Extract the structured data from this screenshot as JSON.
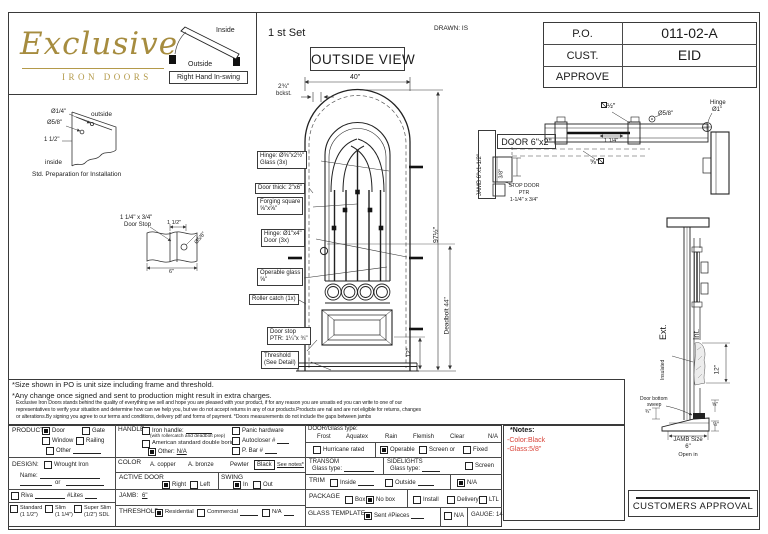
{
  "colors": {
    "brand_gold": "#a68c3f",
    "note_red": "#d9453a",
    "line": "#3a3a3a"
  },
  "header": {
    "logo_title": "Exclusive",
    "logo_subtitle": "IRON DOORS",
    "set_label": "1 st Set",
    "view_label": "OUTSIDE VIEW",
    "drawn_label": "DRAWN: IS",
    "swing_inside": "Inside",
    "swing_outside": "Outside",
    "swing_label": "Right Hand In-swing"
  },
  "info_table": {
    "po_label": "P.O.",
    "po_value": "011-02-A",
    "cust_label": "CUST.",
    "cust_value": "EID",
    "approve_label": "APPROVE",
    "approve_value": ""
  },
  "prep_detail": {
    "dia_quarter": "Ø1/4\"",
    "outside": "outside",
    "dia_58": "Ø5/8\"",
    "dim_1half": "1 1/2\"",
    "inside": "inside",
    "caption": "Std. Preparation for Installation"
  },
  "stop_detail": {
    "size": "1 1/4\" x 3/4\"",
    "name": "Door Stop",
    "dim_1half": "1 1/2\"",
    "dia_58": "Ø5/8\"",
    "width": "6\""
  },
  "elevation": {
    "dim_width": "40\"",
    "backset": "2¾\"",
    "backset_label": "bckst.",
    "dim_height": "97½\"",
    "dim_deadbolt": "Deadbolt 44\"",
    "dim_rail": "12\"",
    "callout_hinge_glass_1": "Hinge: Ø⅝\"x2½\"",
    "callout_hinge_glass_2": "Glass (3x)",
    "callout_thick": "Door thick: 2\"x6\"",
    "callout_forging_1": "Forging square",
    "callout_forging_2": "⅝\"x⅝\"",
    "callout_hinge_door_1": "Hinge: Ø1\"x4\"",
    "callout_hinge_door_2": "Door (3x)",
    "callout_operable_1": "Operable glass",
    "callout_operable_2": "⅝\"",
    "callout_roller": "Roller catch  (1x)",
    "callout_stop_1": "Door stop",
    "callout_stop_2": "PTR: 1¼\"x ¾\"",
    "callout_threshold_1": "Threshold",
    "callout_threshold_2": "(See Detail)"
  },
  "head_section": {
    "jamb_label": "JAMB 6\"x1-1/2\"",
    "door_label": "DOOR 6\"x2\"",
    "dim_38": "3/8\"",
    "stop_1": "STOP DOOR",
    "stop_2": "PTR",
    "stop_3": "1-1/4\" x 3/4\"",
    "sq_half": "½\"",
    "dim_114": "1 1/4\"",
    "sq_58": "⅝\"",
    "dia_58": "Ø5/8\"",
    "hinge_1": "Hinge",
    "hinge_2": "Ø1\""
  },
  "jamb_section": {
    "ext": "Ext.",
    "int": "Int.",
    "insulated": "Insulated",
    "dim_12": "12\"",
    "sweep_1": "Door bottom",
    "sweep_2": "sweep",
    "dim_34": "¾\"",
    "dim_58": "⅝\"",
    "dim_half": "½\"",
    "jamb_size_1": "JAMB Size",
    "jamb_size_2": "6\"",
    "open_in": "Open in"
  },
  "footnotes": {
    "note1": "*Size shown in PO is unit size including frame and threshold.",
    "note2": "*Any change once signed and sent to production might result in extra charges.",
    "fine1": "Exclusive Iron Doors stands behind the quality of everything we sell and hope you are pleased with your product, if for any reason you are unsatis ed you can write to one of our",
    "fine2": "representatives to verify your situation and determine how can we help you, but we do not accept returns in any of our products.Products are  nal and are not eligible for returns, changes",
    "fine3": "or alterations.By signing you agree to our terms and conditions, delivery pdf and forms of payment. *Doors measurements do not include the gaps between jambs"
  },
  "form": {
    "product_label": "PRODUCT:",
    "product_door": "Door",
    "product_gate": "Gate",
    "product_window": "Window",
    "product_railing": "Railing",
    "product_other": "Other",
    "design_label": "DESIGN:",
    "design_wrought": "Wrought Iron",
    "design_name": "Name:",
    "design_or": "or",
    "riva_label": "Riva",
    "lites_label": "#Lites",
    "thick_standard_1": "Standard",
    "thick_standard_2": "(1 1/2\")",
    "thick_slim_1": "Slim",
    "thick_slim_2": "(1 1/4\")",
    "thick_super_1": "Super Slim",
    "thick_super_2": "(1/2\") SDL",
    "handle_label": "HANDLE",
    "handle_iron": "Iron handle:",
    "handle_iron_note": "(with rollercatch and deadbolt prep)",
    "handle_american": "American standard double boring",
    "handle_other": "Other:",
    "handle_other_value": "N/A",
    "handle_panic": "Panic hardware",
    "handle_autocloser": "Autocloser #",
    "handle_pbar": "P. Bar #",
    "color_label": "COLOR",
    "color_copper": "A. copper",
    "color_bronze": "A. bronze",
    "color_pewter": "Pewter",
    "color_black": "Black",
    "color_see_notes": "See notes*",
    "active_label": "ACTIVE DOOR",
    "active_right": "Right",
    "active_left": "Left",
    "swing_label": "SWING",
    "swing_in": "In",
    "swing_out": "Out",
    "jamb_label": "JAMB:",
    "jamb_value": "6\"",
    "threshold_label": "THRESHOLD",
    "threshold_res": "Residential",
    "threshold_com": "Commercial",
    "threshold_na": "N/A",
    "glass_label": "DOOR/Glass type:",
    "glass_frost": "Frost",
    "glass_aquatex": "Aquatex",
    "glass_rain": "Rain",
    "glass_flemish": "Flemish",
    "glass_clear": "Clear",
    "glass_na": "N/A",
    "hurricane": "Hurricane rated",
    "operable": "Operable",
    "screen_or": "Screen or",
    "fixed": "Fixed",
    "transom_label": "TRANSOM",
    "transom_glass": "Glass type:",
    "sidelights_label": "SIDELIGHTS",
    "sidelights_glass": "Glass type:",
    "sidelights_screen": "Screen",
    "trim_label": "TRIM",
    "trim_inside": "Inside",
    "trim_outside": "Outside",
    "trim_na": "N/A",
    "package_label": "PACKAGE",
    "package_box": "Box",
    "package_nobox": "No box",
    "package_install": "Install",
    "package_delivery": "Delivery",
    "package_ltl": "LTL",
    "template_label": "GLASS TEMPLATE",
    "template_sent": "Sent #Pieces",
    "template_na": "N/A",
    "gauge_label": "GAUGE: 14",
    "checks": {
      "product_door": true,
      "product_gate": false,
      "product_window": false,
      "product_railing": false,
      "product_other": false,
      "design_wrought": false,
      "riva": false,
      "standard": false,
      "slim": false,
      "super_slim": false,
      "iron_handle": false,
      "american": false,
      "other": true,
      "panic": false,
      "autocloser": false,
      "pbar": false,
      "active_right": true,
      "active_left": false,
      "swing_in": true,
      "swing_out": false,
      "threshold_res": true,
      "threshold_com": false,
      "threshold_na": false,
      "hurricane": false,
      "operable": true,
      "screen": false,
      "fixed": false,
      "sidelights_screen": false,
      "trim_inside": false,
      "trim_outside": false,
      "trim_na": true,
      "package_box": false,
      "package_nobox": true,
      "package_install": false,
      "package_delivery": false,
      "package_ltl": false,
      "template_sent": true,
      "template_na": false
    }
  },
  "notes": {
    "title": "*Notes:",
    "line1": "-Color:Black",
    "line2": "-Glass:5/8\""
  },
  "approval": {
    "label": "CUSTOMERS APPROVAL"
  }
}
